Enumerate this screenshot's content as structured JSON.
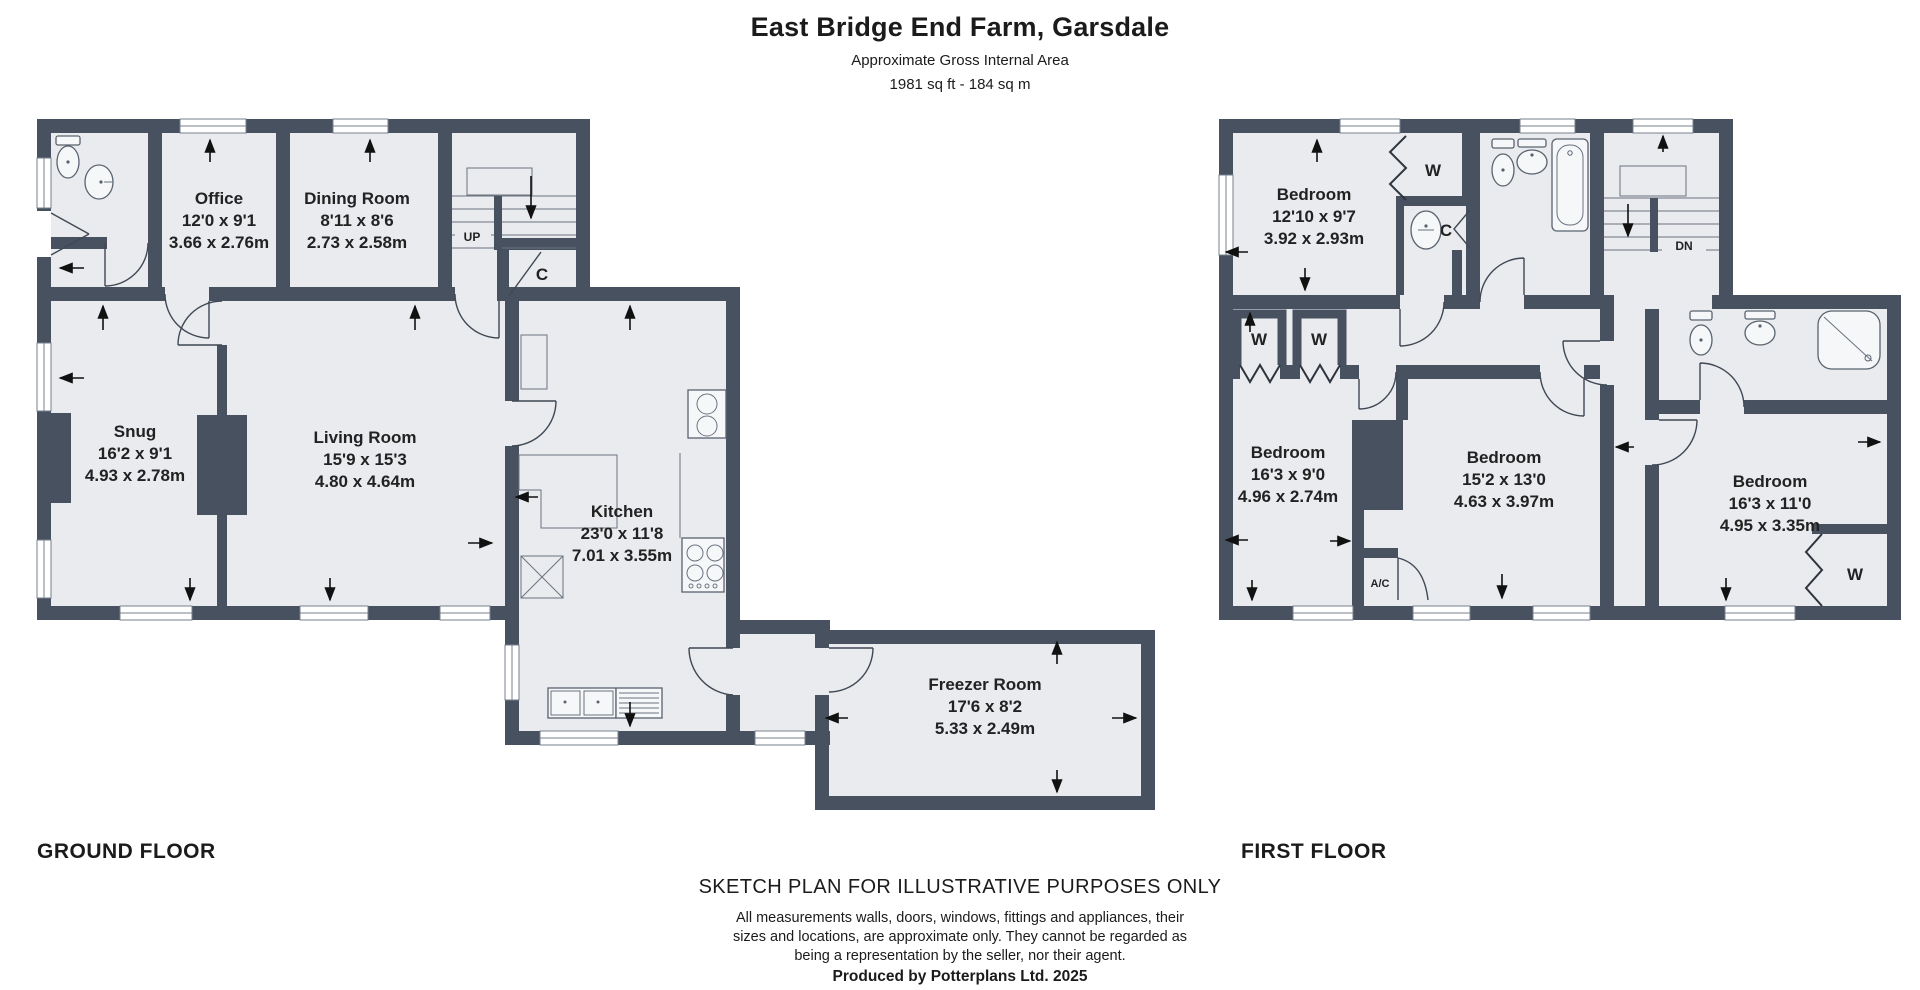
{
  "header": {
    "title": "East Bridge End Farm, Garsdale",
    "subtitle": "Approximate Gross Internal Area",
    "area": "1981 sq ft - 184 sq m"
  },
  "ground_floor": {
    "label": "GROUND FLOOR",
    "stairs": "UP",
    "cupboard": "C",
    "rooms": [
      {
        "name": "Office",
        "imperial": "12'0 x 9'1",
        "metric": "3.66 x 2.76m"
      },
      {
        "name": "Dining Room",
        "imperial": "8'11 x 8'6",
        "metric": "2.73 x 2.58m"
      },
      {
        "name": "Snug",
        "imperial": "16'2 x 9'1",
        "metric": "4.93 x 2.78m"
      },
      {
        "name": "Living Room",
        "imperial": "15'9 x 15'3",
        "metric": "4.80 x 4.64m"
      },
      {
        "name": "Kitchen",
        "imperial": "23'0 x 11'8",
        "metric": "7.01 x 3.55m"
      },
      {
        "name": "Freezer Room",
        "imperial": "17'6 x 8'2",
        "metric": "5.33 x 2.49m"
      }
    ]
  },
  "first_floor": {
    "label": "FIRST FLOOR",
    "stairs": "DN",
    "cupboard": "C",
    "wardrobe": "W",
    "airing_cupboard": "A/C",
    "rooms": [
      {
        "name": "Bedroom",
        "imperial": "12'10 x 9'7",
        "metric": "3.92 x 2.93m"
      },
      {
        "name": "Bedroom",
        "imperial": "16'3 x 9'0",
        "metric": "4.96 x 2.74m"
      },
      {
        "name": "Bedroom",
        "imperial": "15'2 x 13'0",
        "metric": "4.63 x 3.97m"
      },
      {
        "name": "Bedroom",
        "imperial": "16'3 x 11'0",
        "metric": "4.95 x 3.35m"
      }
    ]
  },
  "footer": {
    "disclaimer_title": "SKETCH PLAN FOR ILLUSTRATIVE PURPOSES ONLY",
    "line1": "All measurements walls, doors, windows, fittings and appliances, their",
    "line2": "sizes and locations, are approximate only. They cannot be regarded as",
    "line3": "being a representation by the seller, nor their agent.",
    "credit": "Produced by Potterplans Ltd. 2025"
  },
  "colors": {
    "wall": "#475160",
    "room_fill": "#e9ebee",
    "background": "#ffffff",
    "arrow": "#111111"
  }
}
